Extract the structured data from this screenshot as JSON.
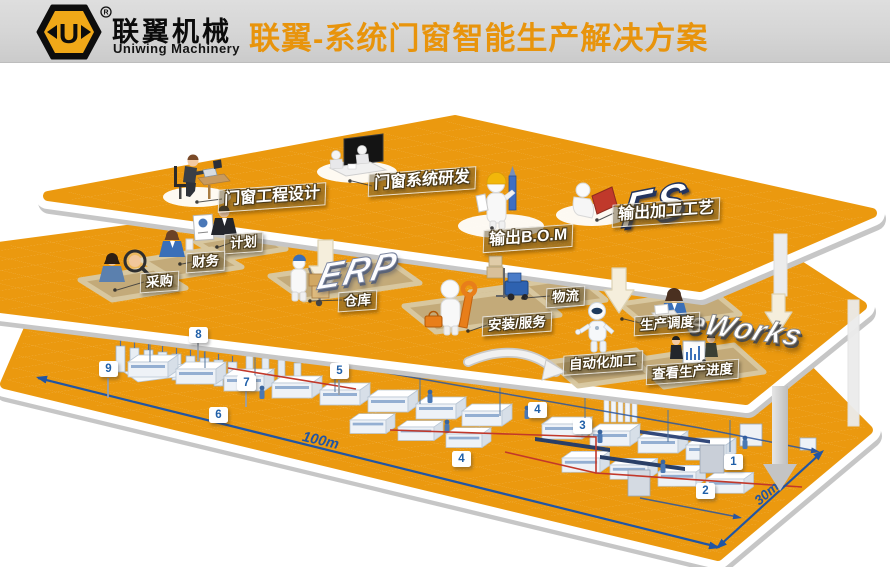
{
  "header": {
    "brand_cn": "联翼机械",
    "brand_en": "Uniwing Machinery",
    "registered": "®",
    "title": "联翼-系统门窗智能生产解决方案"
  },
  "platform_logos": {
    "design": "FS",
    "erp": "ERP",
    "mes": "eWorks"
  },
  "labels": {
    "design": "门窗工程设计",
    "rd": "门窗系统研发",
    "bom": "输出B.O.M",
    "process": "输出加工工艺",
    "plan": "计划",
    "finance": "财务",
    "purchase": "采购",
    "warehouse": "仓库",
    "logistics": "物流",
    "install": "安装/服务",
    "scheduling": "生产调度",
    "auto": "自动化加工",
    "progress": "查看生产进度"
  },
  "factory": {
    "badges": [
      "8",
      "9",
      "7",
      "5",
      "6",
      "4",
      "3",
      "4",
      "1",
      "2"
    ],
    "dim_length": "100m",
    "dim_width": "30m"
  },
  "colors": {
    "platform_orange": "#EB990F",
    "title_orange": "#E8940C",
    "accent_blue": "#2055A4",
    "accent_red": "#C2382A",
    "logo_gold": "#F0A818"
  }
}
